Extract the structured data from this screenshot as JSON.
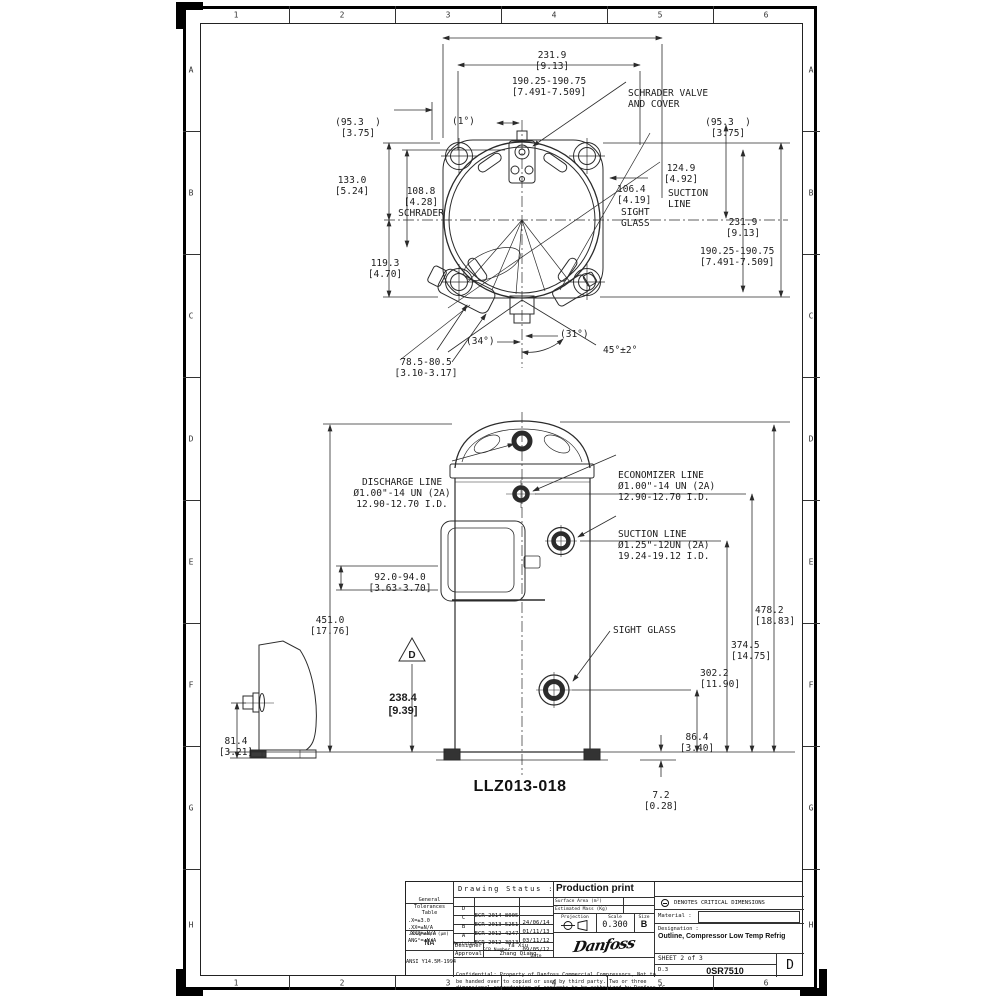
{
  "sheet": {
    "columns": [
      "1",
      "2",
      "3",
      "4",
      "5",
      "6"
    ],
    "rows": [
      "A",
      "B",
      "C",
      "D",
      "E",
      "F",
      "G",
      "H"
    ]
  },
  "top_view": {
    "width_overall": [
      "231.9",
      "[9.13]"
    ],
    "bolt_span": [
      "190.25-190.75",
      "[7.491-7.509]"
    ],
    "schrader_valve": [
      "SCHRADER VALVE",
      "AND COVER"
    ],
    "ref_left": [
      "(95.3  )",
      "[3.75]"
    ],
    "ref_right": [
      "(95.3  )",
      "[3.75]"
    ],
    "angle_1": "(1°)",
    "h133": [
      "133.0",
      "[5.24]"
    ],
    "schrader_dim": [
      "108.8",
      "[4.28]",
      "SCHRADER"
    ],
    "suction124": [
      "124.9",
      "[4.92]"
    ],
    "suction_word": [
      "SUCTION",
      "LINE"
    ],
    "sight106": [
      "106.4",
      "[4.19]"
    ],
    "sight_word": [
      "SIGHT",
      "GLASS"
    ],
    "v231": [
      "231.9",
      "[9.13]"
    ],
    "v190": [
      "190.25-190.75",
      "[7.491-7.509]"
    ],
    "h119": [
      "119.3",
      "[4.70]"
    ],
    "foot_dim": [
      "78.5-80.5",
      "[3.10-3.17]"
    ],
    "a34": "(34°)",
    "a31": "(31°)",
    "a45": "45°±2°"
  },
  "side_view": {
    "discharge_label": [
      "DISCHARGE LINE",
      "Ø1.00\"-14 UN (2A)",
      "12.90-12.70 I.D."
    ],
    "economizer_label": [
      "ECONOMIZER LINE",
      "Ø1.00\"-14 UN (2A)",
      "12.90-12.70 I.D."
    ],
    "suction_label": [
      "SUCTION LINE",
      "Ø1.25\"-12UN (2A)",
      "19.24-19.12 I.D."
    ],
    "bracket_dim": [
      "92.0-94.0",
      "[3.63-3.70]"
    ],
    "h451": [
      "451.0",
      "[17.76]"
    ],
    "datum_letter": "D",
    "datum_dim": [
      "238.4",
      "[9.39]"
    ],
    "h478": [
      "478.2",
      "[18.83]"
    ],
    "h374": [
      "374.5",
      "[14.75]"
    ],
    "h302": [
      "302.2",
      "[11.90]"
    ],
    "sight_glass": "SIGHT GLASS",
    "h86": [
      "86.4",
      "[3.40]"
    ],
    "h7": [
      "7.2",
      "[0.28]"
    ],
    "foot_height": [
      "81.4",
      "[3.21]"
    ],
    "model": "LLZ013-018"
  },
  "title_block": {
    "tol_header": [
      "General",
      "Tolerances",
      "Table"
    ],
    "tol_rows": [
      ".X=±3.0",
      ".XX=±N/A",
      ".XXX=±N/A",
      "ANG°=±N/A"
    ],
    "roughness_label": "Roughness (µm)",
    "roughness_value": "NA",
    "standard": "ANSI Y14.5M-1994",
    "status_label": "Drawing Status :",
    "status_value": "Production print",
    "revisions": [
      {
        "rev": "D",
        "ecr": "ECR-2014-8005",
        "date": "24/06/14"
      },
      {
        "rev": "C",
        "ecr": "ECR-2013-5251",
        "date": "01/11/13"
      },
      {
        "rev": "B",
        "ecr": "ECR-2012-4247",
        "date": "03/11/12"
      },
      {
        "rev": "A",
        "ecr": "ECR-2012-3913",
        "date": "09/05/12"
      }
    ],
    "rev_header": {
      "rev": "Revision",
      "ecr": "ECR Number",
      "date": "Date"
    },
    "designer_label": "Designer",
    "designer_value": "Ya Xiu",
    "approval_label": "Approval",
    "approval_value": "Zhang Qiang",
    "surface_area_label": "Surface Area (m²)",
    "estimated_mass_label": "Estimated Mass (Kg)",
    "projection_label": "Projection",
    "scale_label": "Scale",
    "scale_value": "0.300",
    "size_label": "Size",
    "size_value": "B",
    "logo_text": "Danfoss",
    "confidential": [
      "Confidential: Property of Danfoss Commercial Compressors, Not to",
      "be handed over to copied or used by third party. Two or three",
      "dimensional reproduction of contents to be authorized by Danfoss CC."
    ],
    "critical_note": "DENOTES CRITICAL DIMENSIONS",
    "material_label": "Material :",
    "designation_label": "Designation :",
    "designation_value": "Outline, Compressor Low Temp Refrig",
    "sheet_label": "SHEET 2 of 3",
    "doc_small": "D.3",
    "doc_number": "0SR7510",
    "revision_letter": "D"
  }
}
